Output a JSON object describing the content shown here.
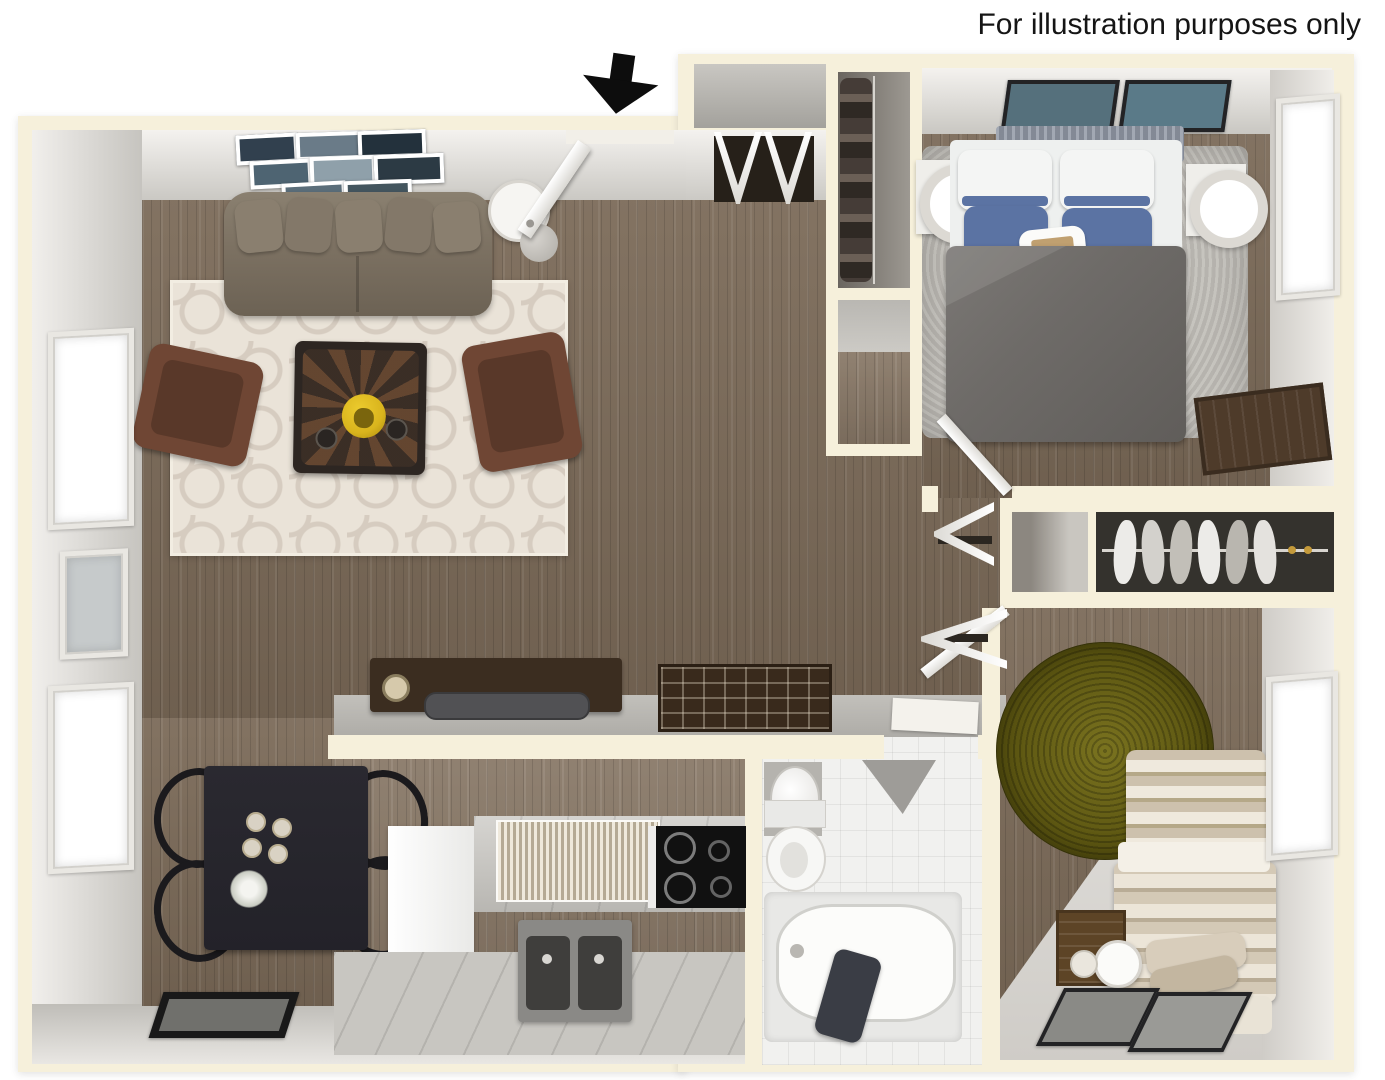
{
  "disclaimer": "For illustration purposes only",
  "floor_plan": {
    "view": "3D top-down apartment floor plan",
    "entry_arrow_icon": "black-down-arrow"
  },
  "colors": {
    "wall_cream": "#f6f0db",
    "wood": "#7b6a58",
    "rug_base": "#eae3d8",
    "rug_pattern": "#d6ccc0",
    "sofa": "#7c7162",
    "armchair": "#6f4634",
    "coffee_table": "#2d2622",
    "bowl_accent": "#d9b41d",
    "dining_table": "#232229",
    "cabinet": "#c8c6c1",
    "stove": "#111111",
    "bath_floor": "#f1f1ef",
    "towel": "#3a3d45",
    "duvet": "#6e6b68",
    "pillow_blue": "#5b73a3",
    "headboard": "#8e95a2",
    "shag_rug": "#c0bdb7",
    "olive_rug": "#5f5913",
    "carpet": "#d8d6d2",
    "window_frame": "#e9e7e2",
    "window_glass": "#ffffff",
    "arrow_black": "#0d0d0d"
  }
}
